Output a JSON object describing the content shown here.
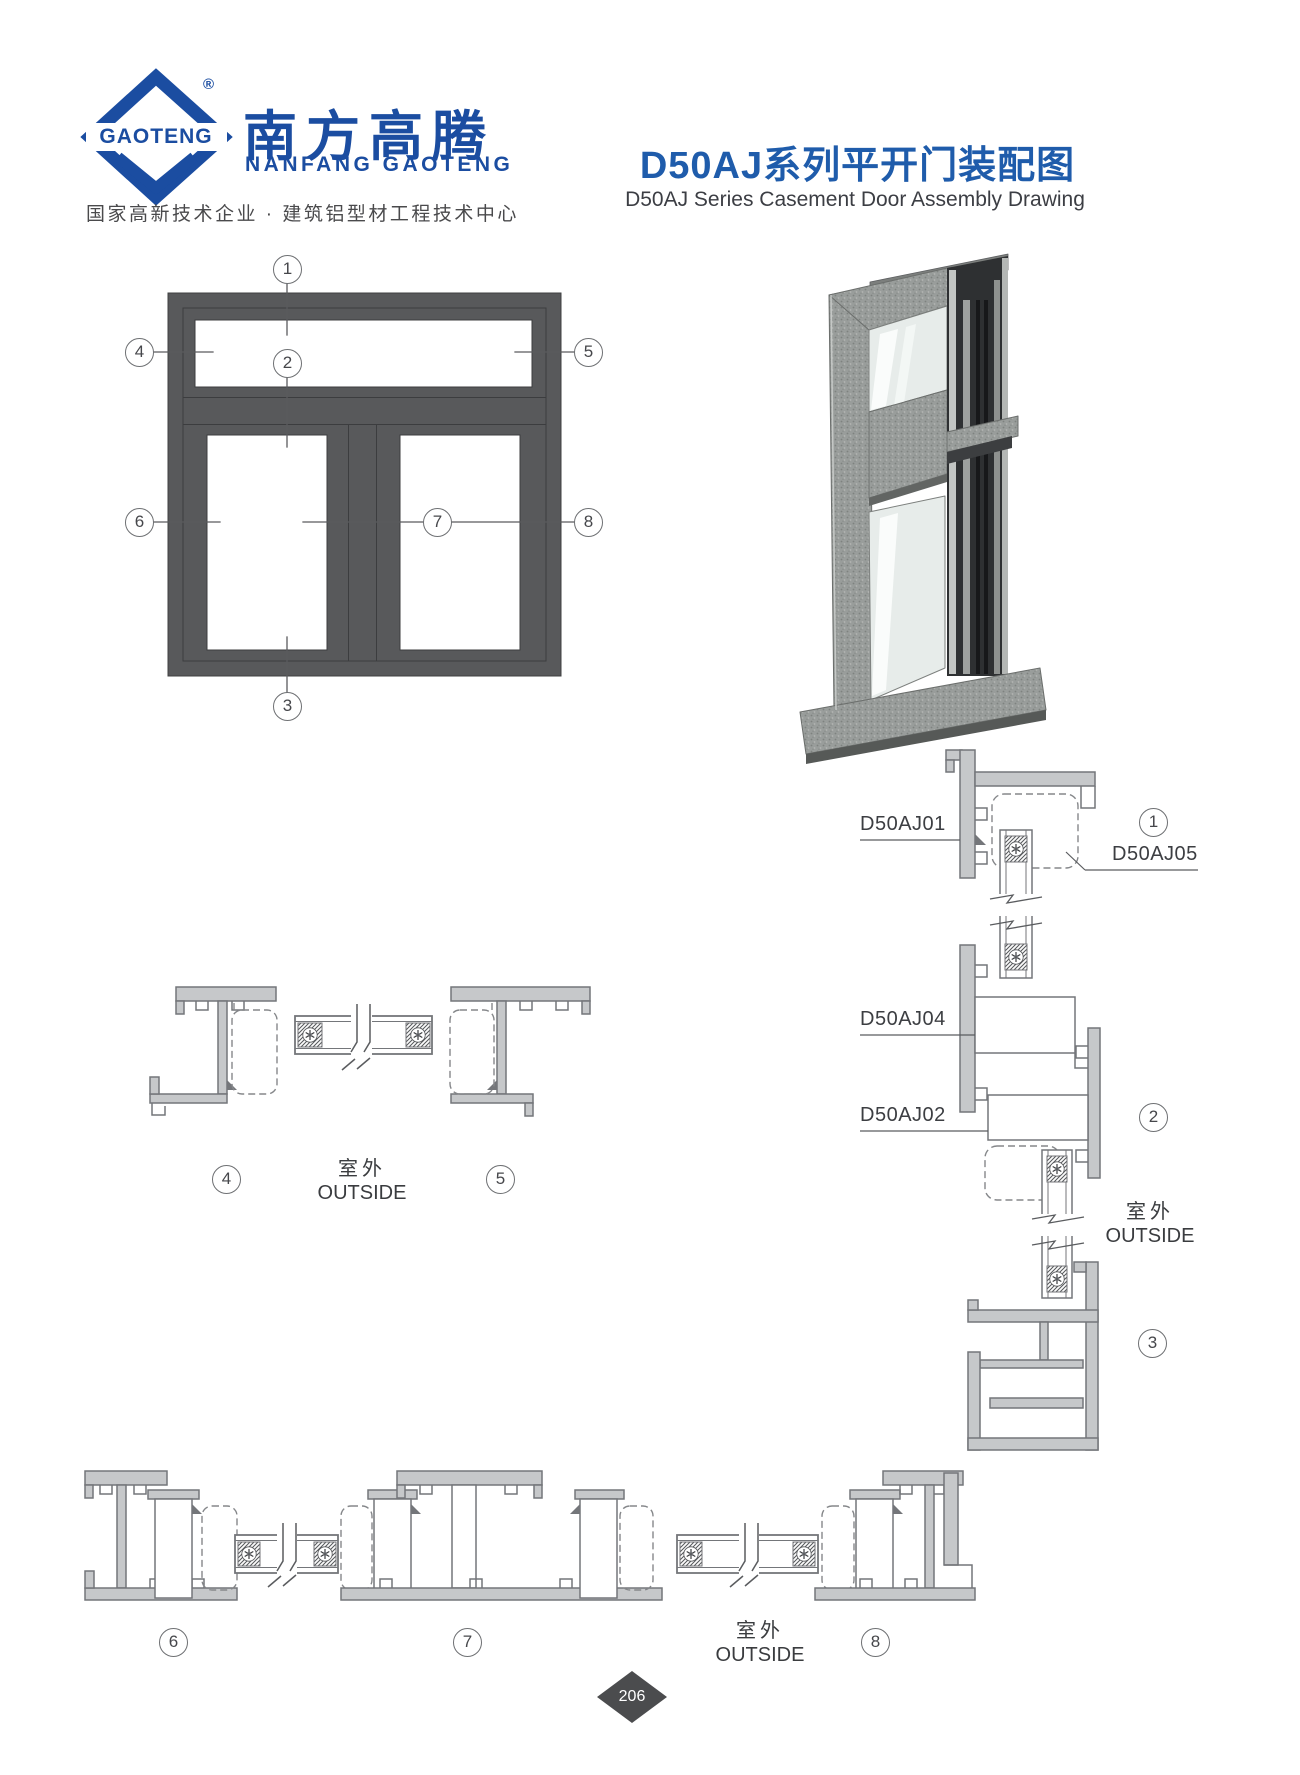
{
  "header": {
    "logo_mark": "GAOTENG",
    "registered": "®",
    "company_cn": "南方高腾",
    "company_en": "NANFANG GAOTENG",
    "tagline": "国家高新技术企业 · 建筑铝型材工程技术中心"
  },
  "title": {
    "cn": "D50AJ系列平开门装配图",
    "en": "D50AJ Series Casement Door Assembly Drawing"
  },
  "elevation": {
    "callouts": [
      "1",
      "2",
      "3",
      "4",
      "5",
      "6",
      "7",
      "8"
    ]
  },
  "section_top": {
    "callouts": [
      "4",
      "5"
    ],
    "outside_cn": "室外",
    "outside_en": "OUTSIDE"
  },
  "section_vertical": {
    "labels": [
      "D50AJ01",
      "D50AJ05",
      "D50AJ04",
      "D50AJ02"
    ],
    "callouts": [
      "1",
      "2",
      "3"
    ],
    "outside_cn": "室外",
    "outside_en": "OUTSIDE"
  },
  "section_bottom": {
    "callouts": [
      "6",
      "7",
      "8"
    ],
    "outside_cn": "室外",
    "outside_en": "OUTSIDE"
  },
  "footer": {
    "page_number": "206"
  },
  "colors": {
    "brand_blue": "#1b4da1",
    "title_blue": "#1f5cab",
    "frame_gray": "#58595b",
    "line_gray": "#74767a",
    "text_gray": "#3c3e42"
  }
}
